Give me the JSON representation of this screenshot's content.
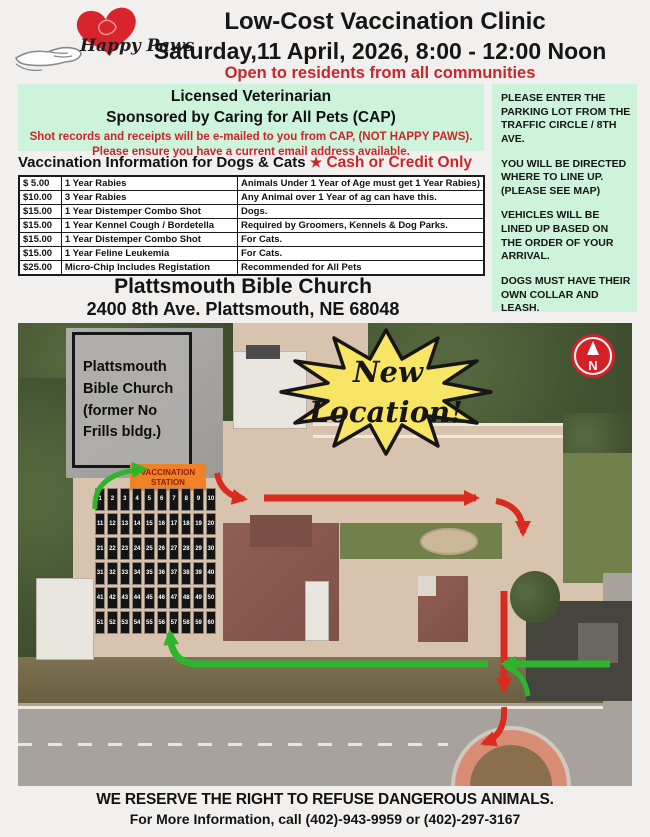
{
  "colors": {
    "mint": "#cdf3da",
    "accent_red": "#c9262b",
    "route_red": "#d92b20",
    "route_green": "#2db52d",
    "burst_yellow": "#f8e565",
    "station_orange": "#f08124",
    "compass_red": "#d42127",
    "map_tan": "#d8c4ae"
  },
  "header": {
    "brand": "Happy Paws",
    "title_line1": "Low-Cost Vaccination Clinic",
    "title_line2": "Saturday,11 April, 2026, 8:00 - 12:00 Noon",
    "subtitle": "Open to residents from all communities"
  },
  "sponsor_box": {
    "line1": "Licensed Veterinarian",
    "line2": "Sponsored by Caring for All Pets (CAP)",
    "notice1": "Shot records and receipts will be e-mailed to you from CAP, (NOT HAPPY PAWS).",
    "notice2": "Please ensure you have a current email address available."
  },
  "info_heading": {
    "text": "Vaccination Information for Dogs & Cats",
    "star": "★",
    "payment": "Cash or Credit Only"
  },
  "price_table": {
    "rows": [
      [
        "$  5.00",
        "1 Year Rabies",
        "Animals Under 1 Year of Age must get 1 Year Rabies)"
      ],
      [
        "$10.00",
        "3 Year Rabies",
        "Any Animal over 1 Year of ag can have this."
      ],
      [
        "$15.00",
        "1 Year Distemper Combo Shot",
        "Dogs."
      ],
      [
        "$15.00",
        "1 Year Kennel Cough / Bordetella",
        "Required by Groomers, Kennels & Dog Parks."
      ],
      [
        "$15.00",
        "1 Year Distemper Combo Shot",
        "For Cats."
      ],
      [
        "$15.00",
        "1 Year Feline Leukemia",
        "For Cats."
      ],
      [
        "$25.00",
        "Micro-Chip Includes Registation",
        "Recommended for All Pets"
      ]
    ]
  },
  "side_panel": {
    "paragraphs": [
      "PLEASE ENTER THE PARKING LOT FROM THE TRAFFIC CIRCLE / 8TH AVE.",
      "YOU WILL BE DIRECTED WHERE TO LINE UP. (PLEASE SEE MAP)",
      "VEHICLES WILL BE LINED UP BASED ON THE ORDER OF YOUR ARRIVAL.",
      "DOGS MUST HAVE THEIR OWN COLLAR AND LEASH."
    ]
  },
  "location": {
    "name": "Plattsmouth Bible Church",
    "address": "2400 8th Ave.  Plattsmouth, NE 68048"
  },
  "map": {
    "building_label_lines": [
      "Plattsmouth",
      "Bible Church",
      "(former No",
      "Frills bldg.)"
    ],
    "station_line1": "VACCINATION",
    "station_line2": "STATION",
    "burst_line1": "New",
    "burst_line2": "Location!",
    "compass_label": "N",
    "parking_spots": [
      1,
      2,
      3,
      4,
      5,
      6,
      7,
      8,
      9,
      10,
      11,
      12,
      13,
      14,
      15,
      16,
      17,
      18,
      19,
      20,
      21,
      22,
      23,
      24,
      25,
      26,
      27,
      28,
      29,
      30,
      31,
      32,
      33,
      34,
      35,
      36,
      37,
      38,
      39,
      40,
      41,
      42,
      43,
      44,
      45,
      46,
      47,
      48,
      49,
      50,
      51,
      52,
      53,
      54,
      55,
      56,
      57,
      58,
      59,
      60
    ]
  },
  "footer": {
    "line1": "WE RESERVE THE RIGHT TO REFUSE DANGEROUS ANIMALS.",
    "line2": "For More Information, call (402)-943-9959 or (402)-297-3167"
  }
}
